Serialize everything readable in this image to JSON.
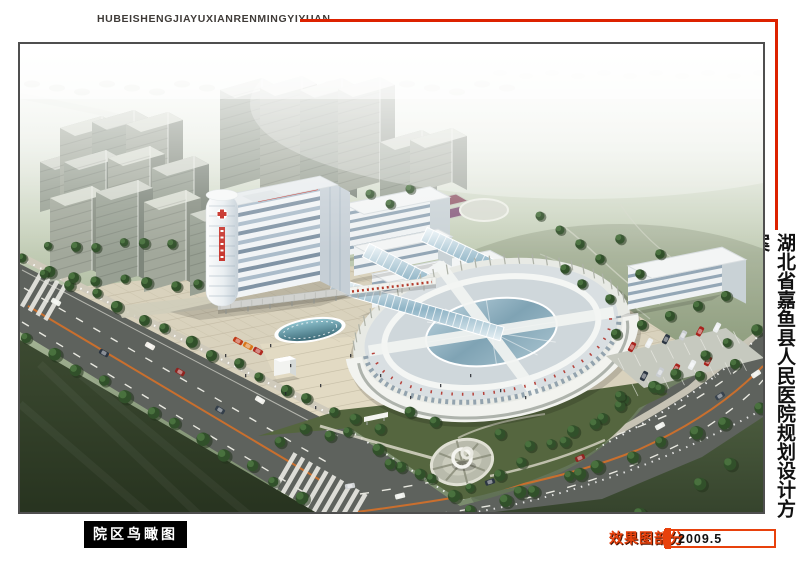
{
  "header": {
    "title": "HUBEISHENGJIAYUXIANRENMINGYIYUAN"
  },
  "side_title": "湖北省嘉鱼县人民医院规划设计方案",
  "caption": "院区鸟瞰图",
  "footer": {
    "section": "效果图部分",
    "date": "2009.5"
  },
  "colors": {
    "accent_red": "#DD2200",
    "footer_red": "#E8410C",
    "caption_bg": "#000000",
    "caption_text": "#FFFFFF",
    "frame_border": "#4F4F4F",
    "page_bg": "#FFFFFF",
    "road_gray": "#5E625D",
    "plaza_beige": "#D9D2BD",
    "lawn_dark_green": "#2F3D26",
    "field_green": "#8A9B7C"
  }
}
